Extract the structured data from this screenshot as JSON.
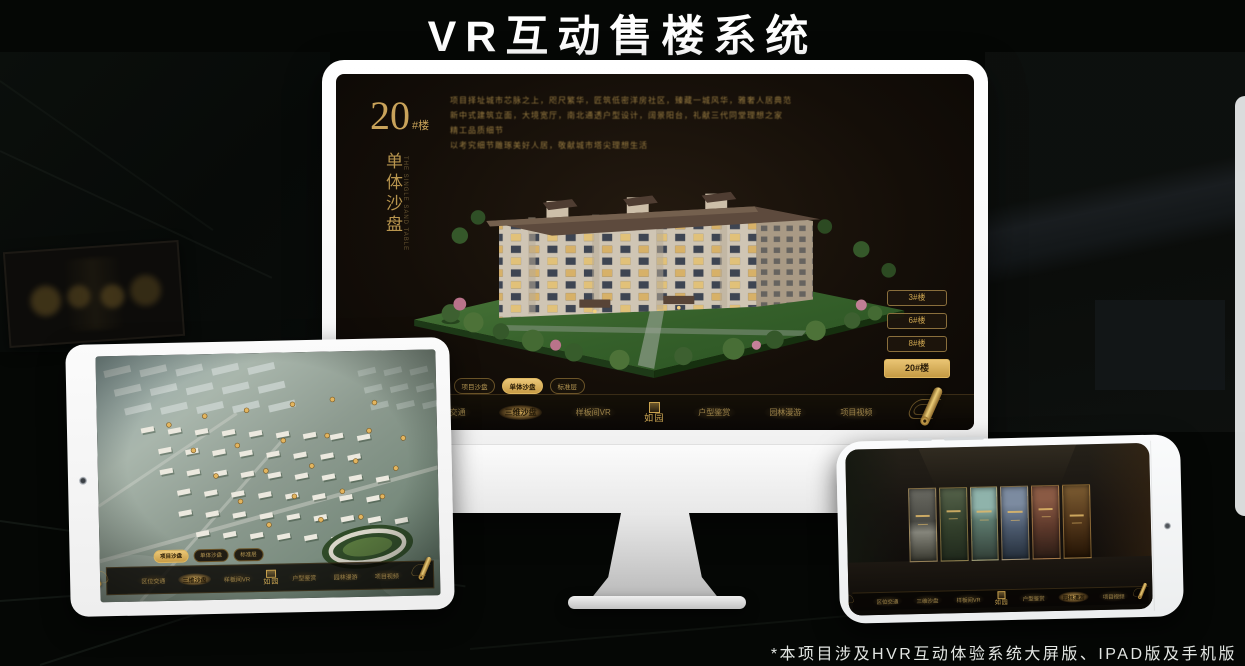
{
  "page": {
    "title": "VR互动售楼系统",
    "footnote": "*本项目涉及HVR互动体验系统大屏版、IPAD版及手机版"
  },
  "colors": {
    "gold": "#c9a35a",
    "gold_bright": "#eccd78",
    "screen_bg": "#140e08",
    "monitor_body": "#f4f4f4"
  },
  "monitor": {
    "title_number": "20",
    "title_suffix": "#楼",
    "title_vertical": "单体沙盘",
    "title_vertical_en": "THE SINGLE SAND TABLE",
    "description_lines": [
      "项目择址城市芯脉之上，咫尺繁华，匠筑低密洋房社区，臻藏一城风华，雅奢人居典范",
      "新中式建筑立面，大境宽厅，南北通透户型设计，阔景阳台，礼献三代同堂理想之家",
      "精工品质细节",
      "以考究细节雕琢美好人居，敬献城市塔尖理想生活"
    ],
    "floor_buttons": [
      {
        "label": "3#楼",
        "active": false
      },
      {
        "label": "6#楼",
        "active": false
      },
      {
        "label": "8#楼",
        "active": false
      },
      {
        "label": "20#楼",
        "active": true
      }
    ],
    "tabs": [
      {
        "label": "项目沙盘",
        "active": false
      },
      {
        "label": "单体沙盘",
        "active": true
      },
      {
        "label": "标准层",
        "active": false
      }
    ],
    "nav": {
      "logo": "如园",
      "items": [
        {
          "label": "区位交通",
          "active": false
        },
        {
          "label": "三维沙盘",
          "active": true
        },
        {
          "label": "样板间VR",
          "active": false
        },
        {
          "label": "户型鉴赏",
          "active": false
        },
        {
          "label": "园林漫游",
          "active": false
        },
        {
          "label": "项目视频",
          "active": false
        }
      ]
    }
  },
  "tablet": {
    "tabs": [
      {
        "label": "项目沙盘",
        "active": true
      },
      {
        "label": "单体沙盘",
        "active": false
      },
      {
        "label": "标准层",
        "active": false
      }
    ],
    "nav": {
      "logo": "如园",
      "items": [
        {
          "label": "区位交通",
          "active": false
        },
        {
          "label": "三维沙盘",
          "active": true
        },
        {
          "label": "样板间VR",
          "active": false
        },
        {
          "label": "户型鉴赏",
          "active": false
        },
        {
          "label": "园林漫游",
          "active": false
        },
        {
          "label": "项目视频",
          "active": false
        }
      ]
    }
  },
  "phone": {
    "nav": {
      "logo": "如园",
      "items": [
        {
          "label": "区位交通",
          "active": false
        },
        {
          "label": "三维沙盘",
          "active": false
        },
        {
          "label": "样板间VR",
          "active": false
        },
        {
          "label": "户型鉴赏",
          "active": false
        },
        {
          "label": "园林漫游",
          "active": true
        },
        {
          "label": "项目视频",
          "active": false
        }
      ]
    }
  }
}
